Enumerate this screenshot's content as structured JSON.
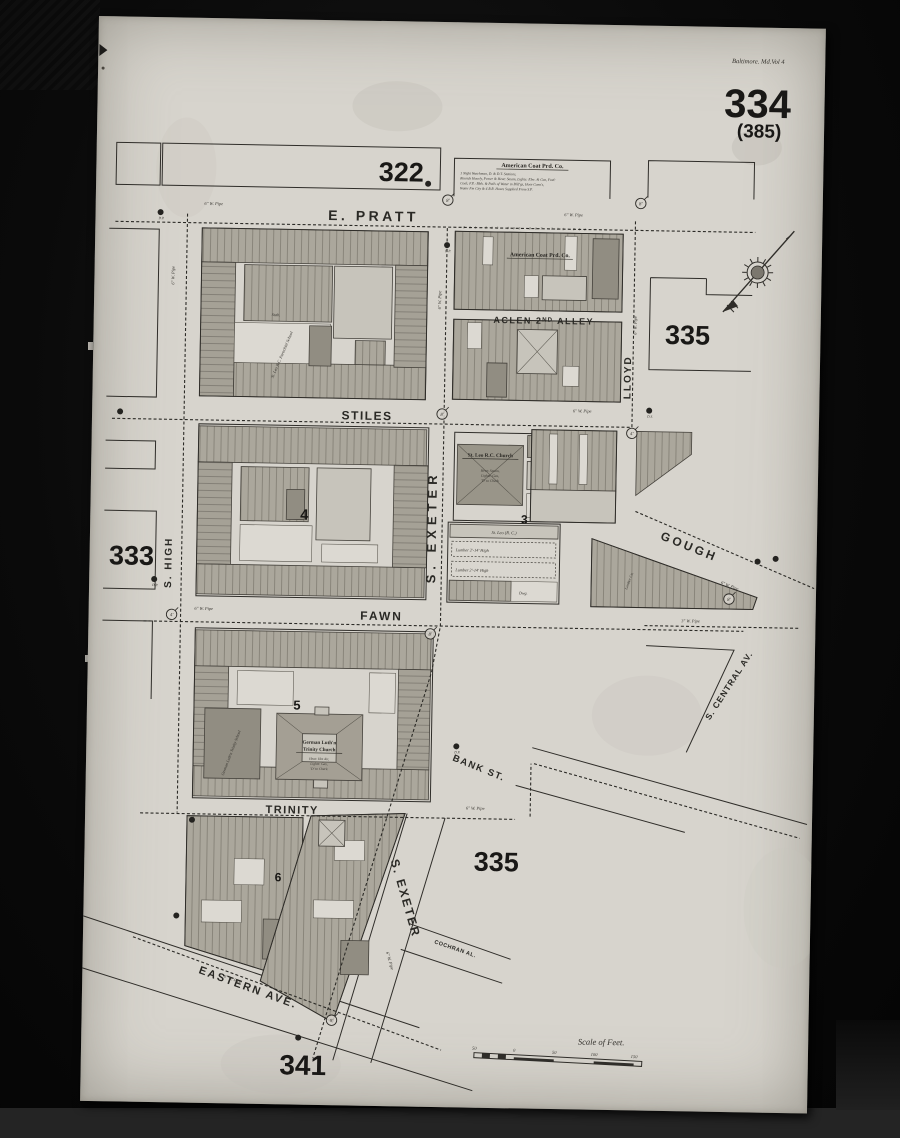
{
  "palette": {
    "paper": "#d7d4cd",
    "ink": "#2f2d29",
    "building_shade": "#aba79c",
    "scan_background": "#0a0a0a"
  },
  "sheet": {
    "volume_line": "Baltimore. Md.Vol 4",
    "number": "334",
    "alt_number": "(385)"
  },
  "adjacent_sheets": {
    "top": "322",
    "right_upper": "335",
    "left": "333",
    "center_lower": "335",
    "bottom": "341"
  },
  "streets": {
    "e_pratt": "E. PRATT",
    "stiles": "STILES",
    "fawn": "FAWN",
    "trinity": "TRINITY",
    "s_high": "S. HIGH",
    "s_exeter_upper": "S. EXETER",
    "s_exeter_lower": "S. EXETER",
    "lloyd": "LLOYD",
    "gough": "GOUGH",
    "bank": "BANK ST.",
    "eastern": "EASTERN AVE.",
    "central": "S. CENTRAL AV.",
    "cochran": "COCHRAN AL.",
    "aclen": "ACLEN 2ᴺᴰ ALLEY"
  },
  "blocks": {
    "three": "3",
    "four": "4",
    "five": "5",
    "six": "6"
  },
  "pois": {
    "american_coat_header": "American Coat Prd. Co.",
    "american_coat_n1": "1 Night Watchman, D. & D.T. Stations,",
    "american_coat_n2": "Rounds Hourly, Power & Heat: Steam, Lights: Elec. & Gas, Fuel:",
    "american_coat_n3": "Coal; F.P.: Bbls. & Pails of Water in B'ld'gs, Hose Conn's,",
    "american_coat_n4": "Water Fm City & 4 R.R. Hoses Supplied From S.P.",
    "american_coat_block": "American Coat Prd. Co.",
    "house_numbers_pratt": "801  803  805  807  809  811",
    "st_leo_church": "St. Leo R.C. Church",
    "st_leo_n1": "Heat: Steam,",
    "st_leo_n2": "Lights: Gas,",
    "st_leo_n3": "'D' to Check",
    "trinity_church_l1": "German Luth'n",
    "trinity_church_l2": "Trinity Church",
    "trinity_n1": "Heat: Hot Air,",
    "trinity_n2": "Lights: Gas,",
    "trinity_n3": "'D' to Check",
    "trinity_school": "German Luth'n Trinity School",
    "parochial_school": "St. Leo R.C. Parochial School",
    "st_leo_hall": "St. Leo  (R. C.)",
    "lumber_a": "Lumber 2'-14' High",
    "lumber_b": "Lumber 2'-14' High",
    "lumber_co": "Lumber Co.",
    "stable": "Stab.",
    "dwg": "Dwg."
  },
  "scale": {
    "title": "Scale of Feet.",
    "ticks": [
      "50",
      "0",
      "50",
      "100",
      "150"
    ]
  },
  "markers": {
    "hydrants": [
      {
        "x": 332,
        "y": 162,
        "label": ""
      },
      {
        "x": 65,
        "y": 195,
        "label": "D.P."
      },
      {
        "x": 352,
        "y": 223,
        "label": "D.P."
      },
      {
        "x": 28,
        "y": 395,
        "label": ""
      },
      {
        "x": 557,
        "y": 385,
        "label": "D.S."
      },
      {
        "x": 65,
        "y": 562,
        "label": "D.P."
      },
      {
        "x": 668,
        "y": 534,
        "label": ""
      },
      {
        "x": 686,
        "y": 531,
        "label": ""
      },
      {
        "x": 370,
        "y": 724,
        "label": "D.P."
      },
      {
        "x": 107,
        "y": 802,
        "label": ""
      },
      {
        "x": 93,
        "y": 898,
        "label": ""
      },
      {
        "x": 217,
        "y": 1018,
        "label": ""
      }
    ],
    "valves": [
      {
        "x": 352,
        "y": 178,
        "label": "8'"
      },
      {
        "x": 545,
        "y": 178,
        "label": "8'"
      },
      {
        "x": 350,
        "y": 392,
        "label": "8'"
      },
      {
        "x": 540,
        "y": 408,
        "label": "4'"
      },
      {
        "x": 83,
        "y": 597,
        "label": "4'"
      },
      {
        "x": 342,
        "y": 612,
        "label": "8'"
      },
      {
        "x": 640,
        "y": 572,
        "label": "8'"
      },
      {
        "x": 250,
        "y": 1000,
        "label": "9'"
      }
    ],
    "pipe_labels": [
      {
        "x": 118,
        "y": 187,
        "rot": 0,
        "text": "6\" W. Pipe"
      },
      {
        "x": 478,
        "y": 192,
        "rot": 0,
        "text": "6\" W. Pipe"
      },
      {
        "x": 490,
        "y": 388,
        "rot": 0,
        "text": "6\" W. Pipe"
      },
      {
        "x": 80,
        "y": 258,
        "rot": -90,
        "text": "6\" W. Pipe"
      },
      {
        "x": 347,
        "y": 278,
        "rot": -90,
        "text": "6\" W. Pipe"
      },
      {
        "x": 543,
        "y": 300,
        "rot": -90,
        "text": "6\" W. Pipe"
      },
      {
        "x": 115,
        "y": 592,
        "rot": 0,
        "text": "6\" W. Pipe"
      },
      {
        "x": 390,
        "y": 787,
        "rot": 0,
        "text": "6\" W. Pipe"
      },
      {
        "x": 602,
        "y": 596,
        "rot": 0,
        "text": "3\" W. Pipe"
      },
      {
        "x": 306,
        "y": 940,
        "rot": 73,
        "text": "6\" W. Pipe"
      },
      {
        "x": 640,
        "y": 560,
        "rot": 21,
        "text": "6\" W. Pipe"
      },
      {
        "x": 150,
        "y": 962,
        "rot": 19,
        "text": "6\" W. Pipe"
      }
    ]
  }
}
